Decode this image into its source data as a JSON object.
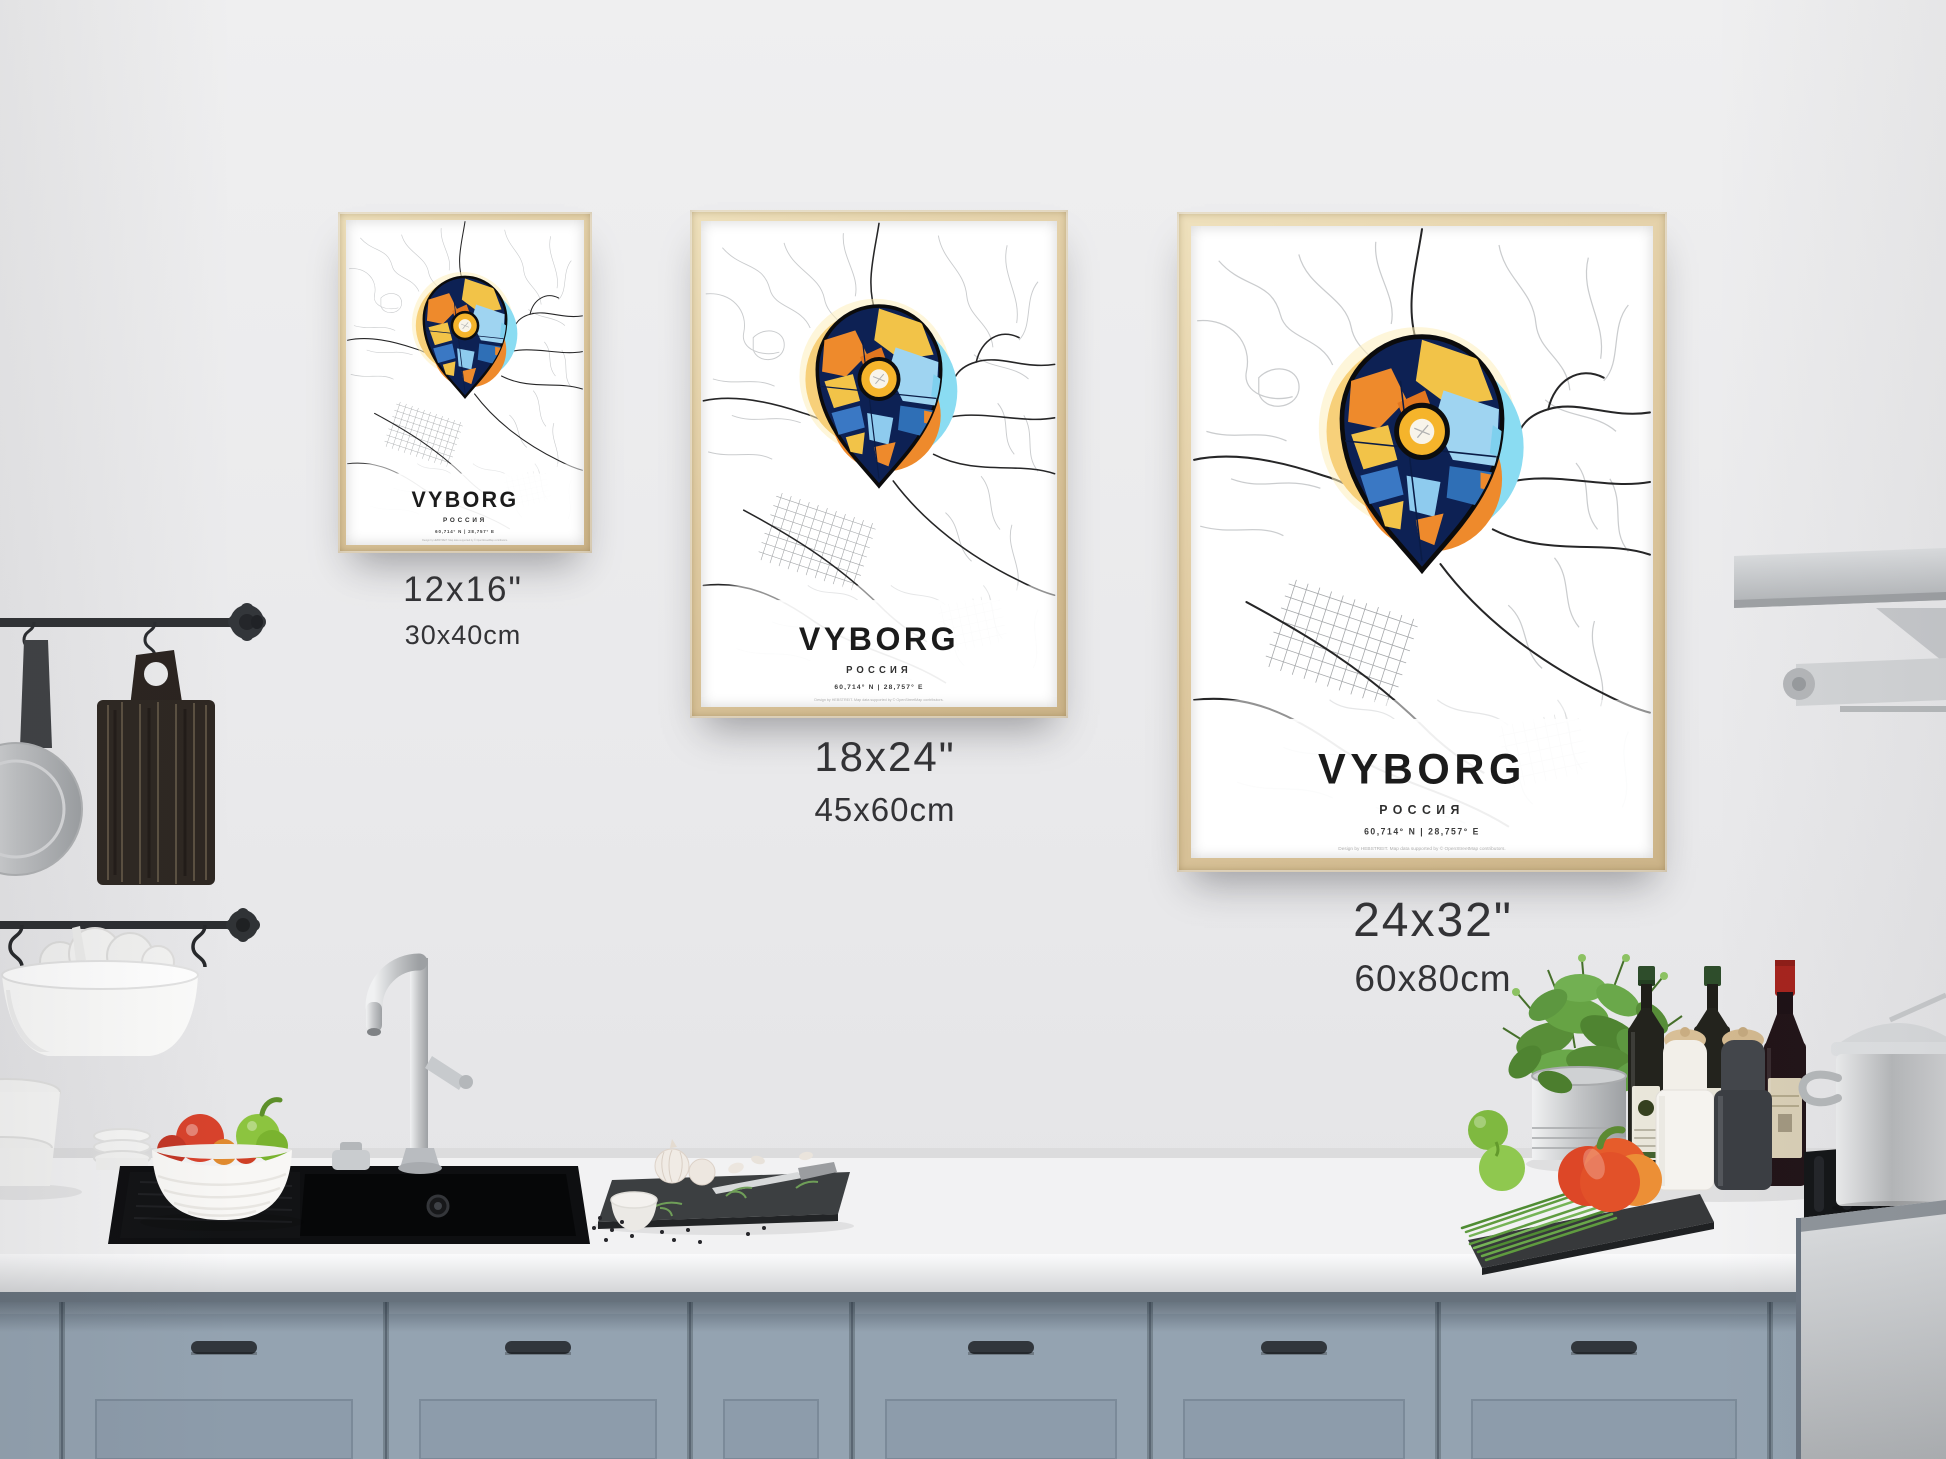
{
  "poster": {
    "title": "VYBORG",
    "subtitle": "РОССИЯ",
    "coordinates": "60,714° N | 28,757° E",
    "attribution": "Design by HEBSTREIT. Map data supported by © OpenStreetMap contributors."
  },
  "size_labels": [
    {
      "inches": "12x16\"",
      "cm": "30x40cm"
    },
    {
      "inches": "18x24\"",
      "cm": "45x60cm"
    },
    {
      "inches": "24x32\"",
      "cm": "60x80cm"
    }
  ],
  "colors": {
    "wall": "#e9e9eb",
    "frame_wood": "#e0cba2",
    "pin_navy": "#0d2154",
    "pin_yellow": "#f5b42b",
    "pin_orange": "#ee8a2c",
    "pin_light_blue": "#9fd4f1",
    "pin_blue": "#2f6fb6",
    "halo_yellow": "#f7d07a",
    "halo_cyan": "#8adcf2",
    "cabinet_blue_gray": "#94a3b1",
    "counter_white": "#f2f2f3",
    "sink_black": "#0e0f11"
  }
}
